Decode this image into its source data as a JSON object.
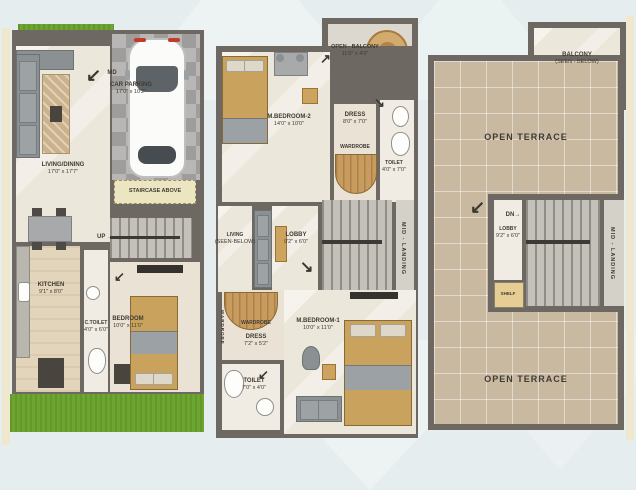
{
  "icons": {
    "arrow_right": "→",
    "arrow_up_right": "↗",
    "arrow_down_left": "↙",
    "arrow_down_right": "↘"
  },
  "ground": {
    "main_door": "MD",
    "car_parking": {
      "label": "CAR PARKING",
      "dims": "17'0\" x 10'2\""
    },
    "living_dining": {
      "label": "LIVING/DINING",
      "dims": "17'0\" x 17'7\""
    },
    "staircase_above": "STAIRCASE ABOVE",
    "up": "UP",
    "kitchen": {
      "label": "KITCHEN",
      "dims": "9'1\" x 8'0\""
    },
    "c_toilet": {
      "label": "C.TOILET",
      "dims": "4'0\" x 6'0\""
    },
    "bedroom": {
      "label": "BEDROOM",
      "dims": "10'0\" x 11'0\""
    }
  },
  "first": {
    "open_balcony": {
      "label": "OPEN - BALCONY",
      "dims": "11'0\" x 4'0\""
    },
    "m_bedroom_2": {
      "label": "M.BEDROOM-2",
      "dims": "14'0\" x 10'0\""
    },
    "dress_2": {
      "label": "DRESS",
      "dims": "8'0\" x 7'0\""
    },
    "wardrobe_2": "WARDROBE",
    "toilet_2": {
      "label": "TOILET",
      "dims": "4'0\" x 7'0\""
    },
    "living_below": {
      "label": "LIVING",
      "dims": "(SEEN-BELOW)"
    },
    "lobby": {
      "label": "LOBBY",
      "dims": "9'2\" x 6'0\""
    },
    "mid_landing": "MID - LANDING",
    "wardrobe_side": "WARDROBE",
    "wardrobe_1": "WARDROBE",
    "dress_1": {
      "label": "DRESS",
      "dims": "7'2\" x 5'2\""
    },
    "toilet_1": {
      "label": "TOILET",
      "dims": "7'0\" x 4'0\""
    },
    "m_bedroom_1": {
      "label": "M.BEDROOM-1",
      "dims": "10'0\" x 11'0\""
    }
  },
  "terrace": {
    "balcony": {
      "label": "BALCONY",
      "dims": "(SEEN - BELOW)"
    },
    "open_terrace_upper": "OPEN TERRACE",
    "dn": "DN",
    "lobby": {
      "label": "LOBBY",
      "dims": "9'2\" x 6'0\""
    },
    "shelf": "SHELF",
    "mid_landing": "MID - LANDING",
    "open_terrace_lower": "OPEN TERRACE"
  }
}
